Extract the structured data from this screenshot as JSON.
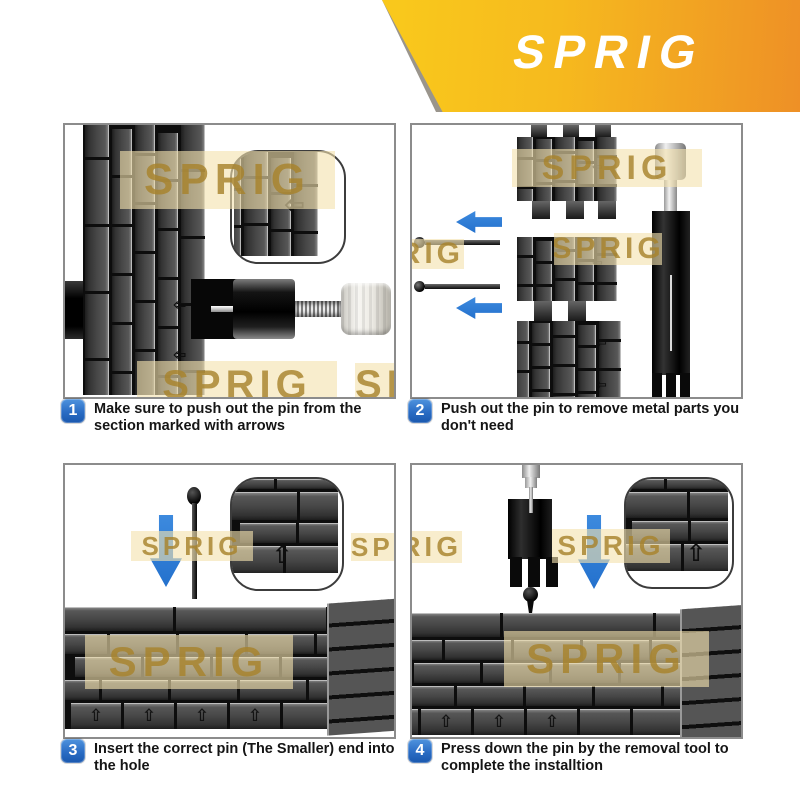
{
  "brand": {
    "logo": "SPRIG"
  },
  "watermark": {
    "text": "SPRIG"
  },
  "icons": {
    "left_arrow": "⇦",
    "up_arrow": "⇧"
  },
  "colors": {
    "badge_blue": "#2a6cc4",
    "arrow_blue": "#2b7cd5",
    "banner_yellow": "#f9c81c",
    "banner_orange": "#ee9026"
  },
  "steps": [
    {
      "number": "1",
      "text": "Make sure to push out the pin from the section marked with arrows"
    },
    {
      "number": "2",
      "text": "Push out the pin to remove metal parts you don't need"
    },
    {
      "number": "3",
      "text": "Insert the correct pin (The Smaller) end into the hole"
    },
    {
      "number": "4",
      "text": "Press down the pin by the removal tool to complete the installtion"
    }
  ]
}
